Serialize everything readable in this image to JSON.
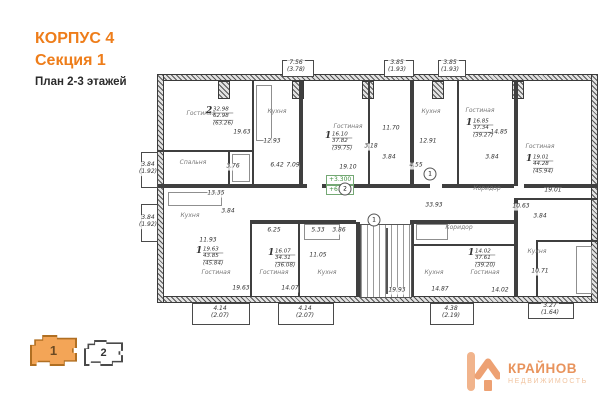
{
  "header": {
    "building": "КОРПУС 4",
    "section": "Секция 1",
    "plan_title": "План 2-3 этажей"
  },
  "plan": {
    "rooms": [
      {
        "label": "Гостиная",
        "x": 201,
        "y": 114
      },
      {
        "label": "Кухня",
        "x": 277,
        "y": 112
      },
      {
        "label": "Спальня",
        "x": 193,
        "y": 163
      },
      {
        "label": "Гостиная",
        "x": 348,
        "y": 127
      },
      {
        "label": "Кухня",
        "x": 431,
        "y": 112
      },
      {
        "label": "Гостиная",
        "x": 480,
        "y": 111
      },
      {
        "label": "Гостиная",
        "x": 540,
        "y": 147
      },
      {
        "label": "Коридор",
        "x": 487,
        "y": 189
      },
      {
        "label": "Коридор",
        "x": 459,
        "y": 228
      },
      {
        "label": "Кухня",
        "x": 190,
        "y": 216
      },
      {
        "label": "Гостиная",
        "x": 216,
        "y": 273
      },
      {
        "label": "Гостиная",
        "x": 274,
        "y": 273
      },
      {
        "label": "Кухня",
        "x": 327,
        "y": 273
      },
      {
        "label": "Кухня",
        "x": 434,
        "y": 273
      },
      {
        "label": "Гостиная",
        "x": 485,
        "y": 273
      },
      {
        "label": "Кухня",
        "x": 537,
        "y": 252
      }
    ],
    "apartments": [
      {
        "num": "2",
        "a1": "32.98",
        "a2": "62.98",
        "a3": "(63.26)",
        "x": 206,
        "y": 107
      },
      {
        "num": "1",
        "a1": "16.10",
        "a2": "37.82",
        "a3": "(39.75)",
        "x": 325,
        "y": 132
      },
      {
        "num": "1",
        "a1": "16.85",
        "a2": "37.34",
        "a3": "(39.27)",
        "x": 466,
        "y": 119
      },
      {
        "num": "1",
        "a1": "19.01",
        "a2": "44.28",
        "a3": "(45.94)",
        "x": 526,
        "y": 155
      },
      {
        "num": "1",
        "a1": "19.63",
        "a2": "43.85",
        "a3": "(45.84)",
        "x": 196,
        "y": 247
      },
      {
        "num": "1",
        "a1": "16.07",
        "a2": "34.31",
        "a3": "(36.08)",
        "x": 268,
        "y": 249
      },
      {
        "num": "1",
        "a1": "14.02",
        "a2": "37.61",
        "a3": "(39.20)",
        "x": 468,
        "y": 249
      }
    ],
    "dims": [
      {
        "t": "7.56",
        "t2": "(3.78)",
        "x": 296,
        "y": 67
      },
      {
        "t": "3.85",
        "t2": "(1.93)",
        "x": 397,
        "y": 67
      },
      {
        "t": "3.85",
        "t2": "(1.93)",
        "x": 450,
        "y": 67
      },
      {
        "t": "3.84",
        "t2": "(1.92)",
        "x": 148,
        "y": 169
      },
      {
        "t": "3.84",
        "t2": "(1.92)",
        "x": 148,
        "y": 222
      },
      {
        "t": "4.14",
        "t2": "(2.07)",
        "x": 220,
        "y": 313
      },
      {
        "t": "4.14",
        "t2": "(2.07)",
        "x": 305,
        "y": 313
      },
      {
        "t": "4.38",
        "t2": "(2.19)",
        "x": 451,
        "y": 313
      },
      {
        "t": "3.27",
        "t2": "(1.64)",
        "x": 550,
        "y": 310
      },
      {
        "t": "19.63",
        "x": 242,
        "y": 133
      },
      {
        "t": "12.93",
        "x": 272,
        "y": 142
      },
      {
        "t": "13.35",
        "x": 216,
        "y": 194
      },
      {
        "t": "3.76",
        "x": 233,
        "y": 167
      },
      {
        "t": "6.42",
        "x": 277,
        "y": 166
      },
      {
        "t": "7.09",
        "x": 293,
        "y": 166
      },
      {
        "t": "3.18",
        "x": 371,
        "y": 147
      },
      {
        "t": "3.84",
        "x": 389,
        "y": 158
      },
      {
        "t": "11.70",
        "x": 391,
        "y": 129
      },
      {
        "t": "12.91",
        "x": 428,
        "y": 142
      },
      {
        "t": "19.10",
        "x": 348,
        "y": 168
      },
      {
        "t": "4.55",
        "x": 416,
        "y": 166
      },
      {
        "t": "14.85",
        "x": 499,
        "y": 133
      },
      {
        "t": "3.84",
        "x": 492,
        "y": 158
      },
      {
        "t": "19.01",
        "x": 553,
        "y": 191
      },
      {
        "t": "10.63",
        "x": 521,
        "y": 207
      },
      {
        "t": "3.84",
        "x": 540,
        "y": 217
      },
      {
        "t": "33.93",
        "x": 434,
        "y": 206
      },
      {
        "t": "10.71",
        "x": 540,
        "y": 272
      },
      {
        "t": "14.02",
        "x": 500,
        "y": 291
      },
      {
        "t": "11.93",
        "x": 208,
        "y": 241
      },
      {
        "t": "6.25",
        "x": 274,
        "y": 231
      },
      {
        "t": "5.33",
        "x": 318,
        "y": 231
      },
      {
        "t": "3.86",
        "x": 339,
        "y": 231
      },
      {
        "t": "11.05",
        "x": 318,
        "y": 256
      },
      {
        "t": "3.84",
        "x": 228,
        "y": 212
      },
      {
        "t": "19.63",
        "x": 241,
        "y": 289
      },
      {
        "t": "14.07",
        "x": 290,
        "y": 289
      },
      {
        "t": "19.93",
        "x": 397,
        "y": 291
      },
      {
        "t": "14.87",
        "x": 440,
        "y": 290
      }
    ],
    "bubbles": [
      {
        "t": "1",
        "x": 374,
        "y": 220
      },
      {
        "t": "2",
        "x": 345,
        "y": 189
      },
      {
        "t": "1",
        "x": 430,
        "y": 174
      }
    ],
    "marks": {
      "m1": "+3.300",
      "m2": "+6.600"
    }
  },
  "tabs": [
    {
      "label": "1",
      "active": true
    },
    {
      "label": "2",
      "active": false
    }
  ],
  "logo": {
    "icon": "house-k-icon",
    "title": "КРАЙНОВ",
    "subtitle": "НЕДВИЖИМОСТЬ"
  },
  "colors": {
    "accent_orange": "#ee7d1a",
    "tab_active_fill": "#f3a557",
    "logo_orange": "#e8935c",
    "elevation_green": "#3f8f3f"
  }
}
